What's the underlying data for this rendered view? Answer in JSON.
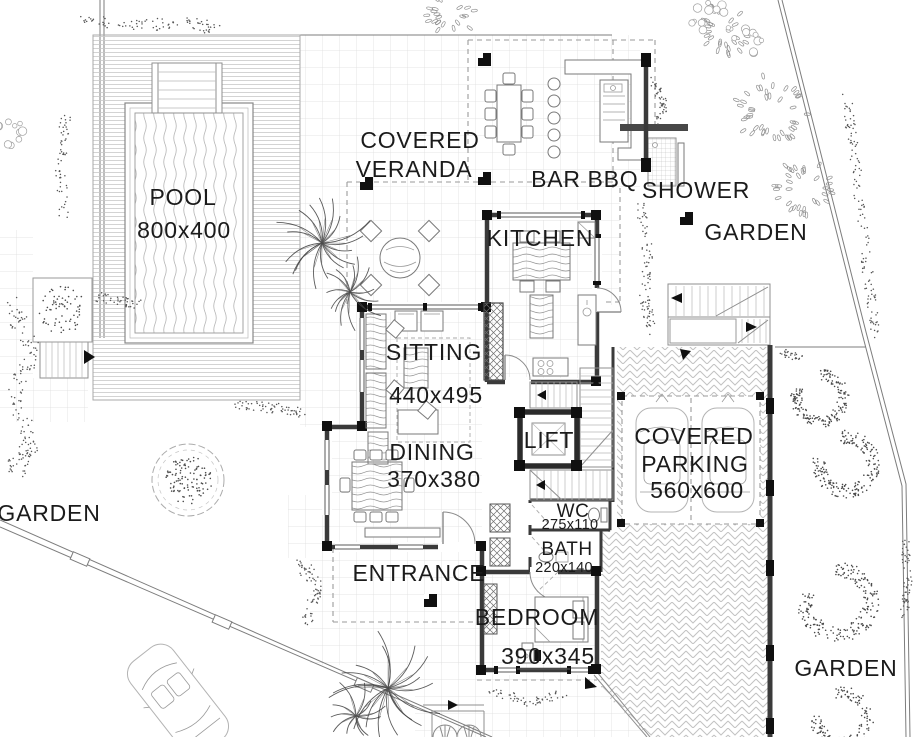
{
  "plan_type": "floor-plan",
  "colors": {
    "ink": "#1b1b1b",
    "wall": "#3a3a3a",
    "corner_block": "#101010",
    "light_line": "#c9c9c9",
    "background": "#ffffff"
  },
  "areas": {
    "pool": {
      "label": "POOL",
      "size": "800x400"
    },
    "veranda": {
      "line1": "COVERED",
      "line2": "VERANDA"
    },
    "bar": {
      "label": "BAR"
    },
    "bbq": {
      "label": "BBQ"
    },
    "shower": {
      "label": "SHOWER"
    },
    "kitchen": {
      "label": "KITCHEN"
    },
    "sitting": {
      "label": "SITTING",
      "size": "440x495"
    },
    "dining": {
      "label": "DINING",
      "size": "370x380"
    },
    "lift": {
      "label": "LIFT"
    },
    "wc": {
      "label": "WC",
      "size": "275x110"
    },
    "bath": {
      "label": "BATH",
      "size": "220x140"
    },
    "bedroom": {
      "label": "BEDROOM",
      "size": "390x345"
    },
    "entrance": {
      "label": "ENTRANCE"
    },
    "parking": {
      "line1": "COVERED",
      "line2": "PARKING",
      "size": "560x600"
    },
    "garden_northeast": {
      "label": "GARDEN"
    },
    "garden_west": {
      "label": "GARDEN"
    },
    "garden_southeast": {
      "label": "GARDEN"
    }
  }
}
